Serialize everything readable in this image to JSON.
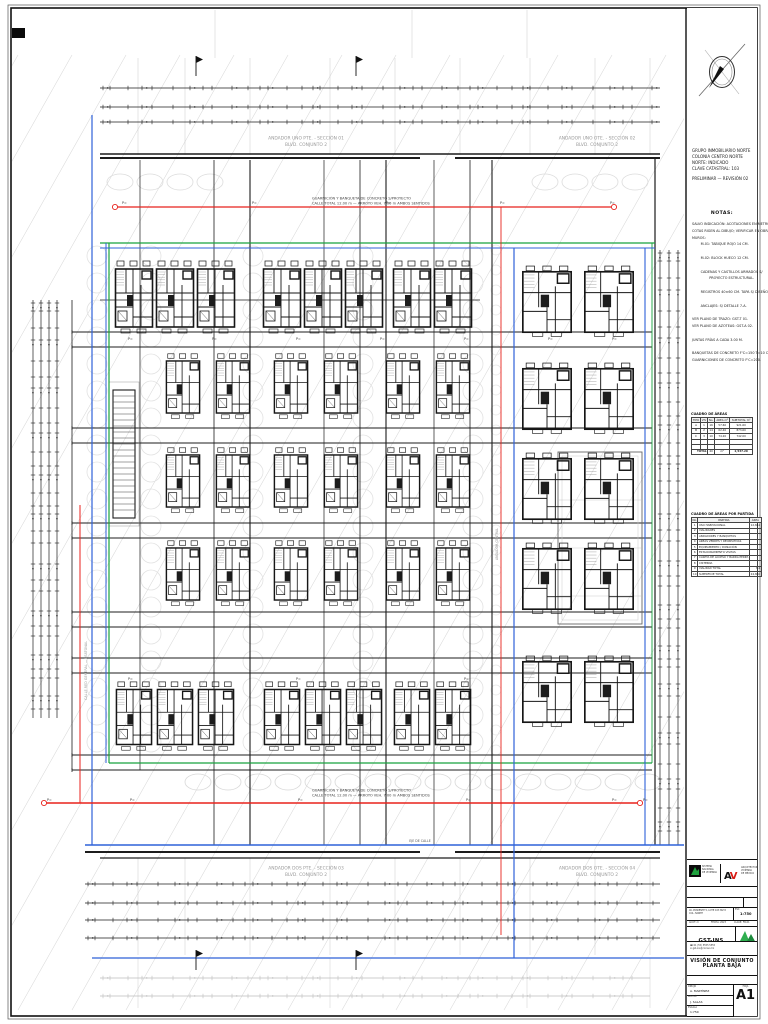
{
  "panel": {
    "info_lines": [
      "GRUPO INMOBILIARIO NORTE",
      "COLONIA CENTRO NORTE",
      "NORTE: INDICADO",
      "CLAVE CATASTRAL: 103",
      "PRELIMINAR — REVISIÓN 02"
    ],
    "notes_title": "NOTAS:",
    "notes": [
      "SALVO INDICACIÓN: ACOTACIONES EN METROS.",
      "COTAS RIGEN AL DIBUJO; VERIFICAR EN OBRA.",
      "MUROS:",
      "        M-01: TABIQUE ROJO 14 CM.",
      "",
      "        M-02: BLOCK HUECO 12 CM.",
      "",
      "        CADENAS Y CASTILLOS ARMADOS S/",
      "                PROYECTO ESTRUCTURAL.",
      "",
      "        REGISTROS 40×60 CM. TAPA S/ DISEÑO.",
      "",
      "        ANCLAJES: S/ DETALLE 7-A.",
      "",
      "VER PLANO DE TRAZO: GST-T 01.",
      "VER PLANO DE AZOTEAS: GST-A 02.",
      "",
      "JUNTAS FRÍAS A CADA 3.00 M.",
      "",
      "BANQUETAS DE CONCRETO F'C=150 T=10 CM.",
      "GUARNICIONES DE CONCRETO F'C=200."
    ],
    "table1": {
      "title": "CUADRO DE ÁREAS",
      "headers": [
        "TIPO",
        "VIV",
        "No.",
        "ÁREA m²",
        "SUBTOTAL m²"
      ],
      "rows": [
        [
          "A",
          "1",
          "16",
          "57.60",
          "921.60"
        ],
        [
          "B",
          "2",
          "14",
          "62.40",
          "873.60"
        ],
        [
          "C",
          "3",
          "10",
          "74.20",
          "742.00"
        ],
        [
          "",
          "",
          "",
          "",
          ""
        ],
        [
          "",
          "",
          "",
          "",
          ""
        ]
      ],
      "total_label": "TOTAL",
      "total_count": "40",
      "total_area": "2,537.20",
      "total_unit": "m²"
    },
    "table2": {
      "title": "CUADRO DE ÁREAS POR PARTIDA",
      "headers": [
        "No.",
        "PARTIDA",
        "ÁREA"
      ],
      "rows": [
        [
          "1",
          "USO HABITACIONAL",
          "12,842"
        ],
        [
          "2",
          "VIALIDADES",
          ""
        ],
        [
          "3",
          "ANDADORES Y BANQUETAS",
          ""
        ],
        [
          "4",
          "ÁREAS VERDES Y RECREATIVAS",
          ""
        ],
        [
          "5",
          "EQUIPAMIENTO / DONACIÓN",
          ""
        ],
        [
          "6",
          "ESTACIONAMIENTO VISITAS",
          ""
        ],
        [
          "7",
          "CASETA DE ACCESO Y BARDA PERIM.",
          ""
        ],
        [
          "8",
          "CISTERNA",
          ""
        ],
        [
          "9",
          "VIALIDAD TOTAL",
          "7,2"
        ],
        [
          "10",
          "SUPERFICIE TOTAL",
          "24,880"
        ]
      ]
    }
  },
  "logos": {
    "left_lines": [
      "SISTEMA",
      "NACIONAL",
      "DE VIVIENDA"
    ],
    "right_mark_a": "A",
    "right_mark_v": "V",
    "right_lines": [
      "ARQUITECTURA",
      "VIVIENDA",
      "DE MÉXICO"
    ]
  },
  "title_block": {
    "project_type": "PROYECTO EJECUTIVO",
    "project_name": "CONJUNTO FB",
    "project_flag": "T1",
    "address_line1": "AV. PONIENTE 5, LOTE 103 MZ 8",
    "address_line2": "COL. NORTE",
    "scale_label": "ESC",
    "scale_value": "1:750",
    "strip_left": "ACOT: m",
    "strip_mid": "FECHA: 2023",
    "strip_right": "CLAVE: FB-01",
    "firm_code": "GST-INS",
    "contact_phone": "☎ 01 (55) 5555 5555",
    "contact_mail": "✉ gst-ins@correo.mx",
    "brand_small": "GPO-MX",
    "sheet_title_line1": "VISIÓN DE CONJUNTO",
    "sheet_title_line2": "PLANTA BAJA",
    "sheet_subtitle": "ALBAÑILERÍA",
    "meta_rows": [
      {
        "label": "DIBUJÓ",
        "value": "A. MARTÍNEZ"
      },
      {
        "label": "REVISÓ",
        "value": "J. SALAS"
      },
      {
        "label": "ESCALA",
        "value": "1:750"
      }
    ],
    "sheet_label": "HOJA",
    "sheet_number": "A1"
  },
  "drawing": {
    "colors": {
      "green": "#18a23e",
      "blue": "#2f62d8",
      "red": "#e8221c",
      "line": "#1c1c1c",
      "faint": "#d9d9d9",
      "label": "#9a9a9a"
    },
    "street_labels": {
      "top_left_1": "ANDADOR UNO PTE. - SECCIÓN 01",
      "top_left_2": "BLVD. CONJUNTO 2",
      "top_right_1": "ANDADOR UNO OTE. - SECCIÓN 02",
      "top_right_2": "BLVD. CONJUNTO 2",
      "bottom_left_1": "ANDADOR DOS PTE. - SECCIÓN 03",
      "bottom_left_2": "BLVD. CONJUNTO 2",
      "bottom_right_1": "ANDADOR DOS OTE. - SECCIÓN 04",
      "bottom_right_2": "BLVD. CONJUNTO 2"
    },
    "caption_top_1": "GUARNICIÓN Y BANQUETA DE CONCRETO S/PROYECTO",
    "caption_top_2": "CALLE TOTAL 12.00 m — ARROYO VEH. 7.00 m AMBOS SENTIDOS",
    "caption_bottom_1": "GUARNICIÓN Y BANQUETA DE CONCRETO S/PROYECTO",
    "caption_bottom_2": "CALLE TOTAL 12.00 m — ARROYO VEH. 7.00 m AMBOS SENTIDOS",
    "axis_label_right_top": "PROL. PTE. 5-A · BLVD. XO",
    "axis_label_right_bottom": "PROL. PTE. 5-A · BLVD. XO",
    "axis_label_left": "CALLE RED GENERAL — PEATONAL",
    "center_label": "ANDADOR CENTRAL",
    "axis_mark": "EJE DE CALLE",
    "level_marker": "P="
  }
}
